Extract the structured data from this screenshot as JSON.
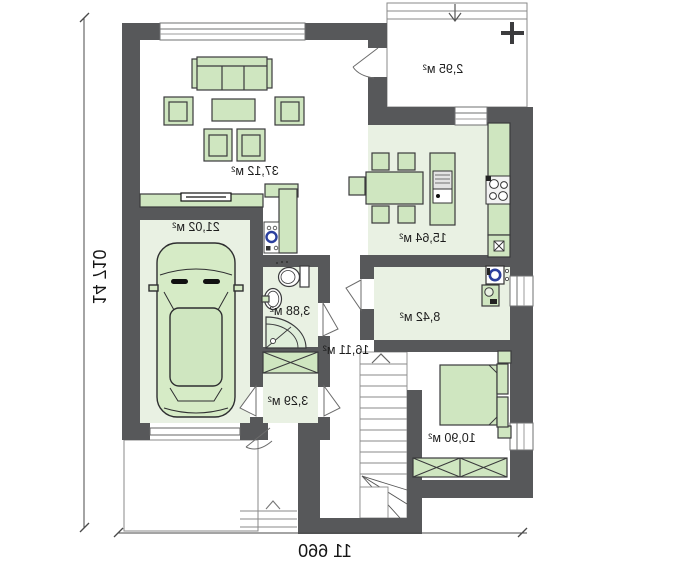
{
  "plan": {
    "type": "floor-plan",
    "mirrored": true,
    "rooms": {
      "living_room": {
        "label": "37,12 м²"
      },
      "garage": {
        "label": "21,02 м²"
      },
      "kitchen_dining": {
        "label": "15,64 м²"
      },
      "porch": {
        "label": "2,95 м²"
      },
      "bathroom": {
        "label": "3,88 м²"
      },
      "hall": {
        "label": "16,11 м²"
      },
      "closet": {
        "label": "3,29 м²"
      },
      "utility_room": {
        "label": "8,42 м²"
      },
      "bedroom": {
        "label": "10,90 м²"
      }
    },
    "dimensions": {
      "overall_depth": "14 710",
      "overall_width": "11 660"
    },
    "colors": {
      "wall": "#57585a",
      "room_fill": "#e9f1e3",
      "furniture_fill": "#cfe6c0",
      "outline": "#3a3a3c",
      "accent_blue": "#2b3f9d"
    }
  }
}
